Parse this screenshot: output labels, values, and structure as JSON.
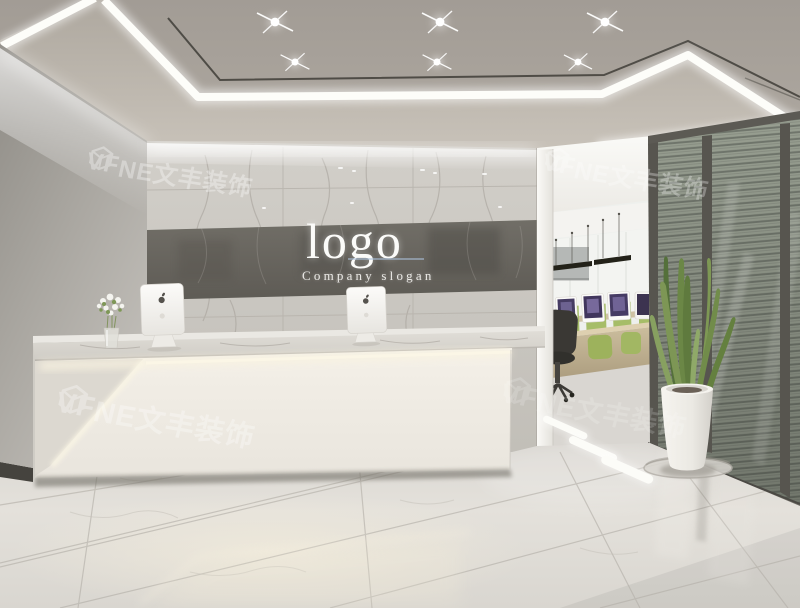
{
  "branding": {
    "logo_text": "logo",
    "slogan_text": "Company slogan"
  },
  "watermark": {
    "prefix": "VF",
    "suffix": "NE文丰装饰"
  },
  "colors": {
    "ceiling": "#a6a099",
    "ceiling_soffit": "#b4aea6",
    "led_white": "#fdfdf9",
    "wall_left": "#9d9a94",
    "wall_left_light": "#c7c4bf",
    "marble_light": "#cdcac4",
    "marble_band": "#696660",
    "desk_front": "#f2eee6",
    "desk_glow": "#f8f2df",
    "desk_top": "#dbd8d2",
    "floor": "#e2dfda",
    "floor_dark": "#cfccc6",
    "frame_dark": "#57554f",
    "blinds_light": "#99a092",
    "blinds_dark": "#6e746a",
    "office_wood": "#c5b696",
    "office_green": "#a6bd68",
    "screen_purple": "#4a3f68",
    "chair_black": "#363430",
    "plant_green": "#6f8a48",
    "pot_white": "#f0eee8",
    "text_white": "#fbfbf9",
    "watermark": "#ffffff"
  }
}
